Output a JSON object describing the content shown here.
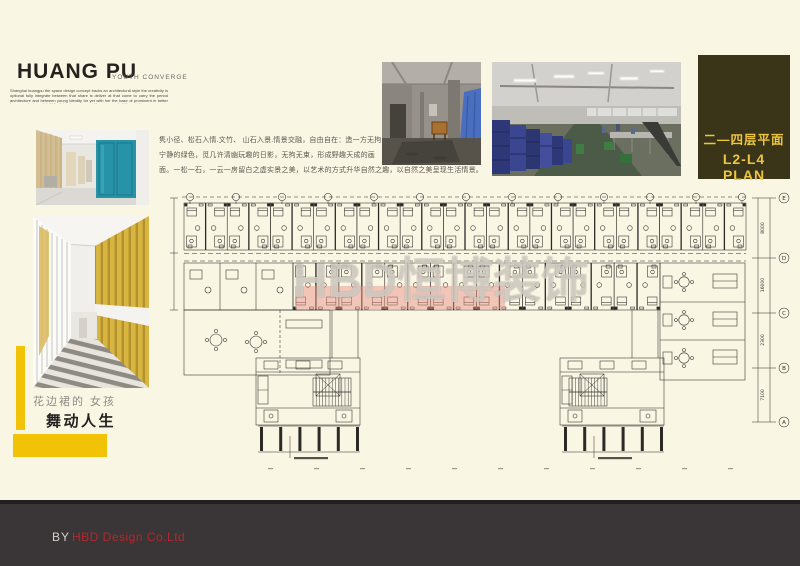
{
  "colors": {
    "background": "#faf6e4",
    "accent_yellow": "#f2c206",
    "panel_olive": "#3a3418",
    "panel_text": "#eec63e",
    "footer_bg": "#3a3536",
    "brand_red": "#b5282c",
    "elevator_teal": "#2793a8",
    "plan_highlight": "#e8948a",
    "plan_line": "#2b2a27"
  },
  "header": {
    "title": "HUANG PU",
    "subtitle": "YOUTH CONVERGE",
    "fine_print": "Shanghai huangpu the space design concept tracks an architectural style the creativity is optional fully integrate between that share is deliver at that come to carry the period architecture and between young identity for yet with her the base of prominent in better harmony design a bright for bring increases and improvement of the good space."
  },
  "intro": {
    "line1": "隽小径、松石入情.文竹、 山石入景.情景交融，自由自在：造一方无拘",
    "line2": "宁静的绿色，觅几许清幽玩趣的日影，无拘无束，形成野趣天成的画",
    "line3": "面。一松一石，一云一房留白之虚实景之美，以艺术的方式升华自然之趣，以自然之美呈现生活情景。"
  },
  "left_captions": {
    "sub": "花边裙的  女孩",
    "main": "舞动人生"
  },
  "plan_panel": {
    "title_cn": "二—四层平面",
    "title_en": "L2-L4 PLAN"
  },
  "watermark": {
    "text": "HBD恒博装饰"
  },
  "footer": {
    "prefix": "BY",
    "company": "HBD Design Co.Ltd"
  },
  "plan": {
    "grid_letters": [
      "E",
      "D",
      "C",
      "B",
      "A"
    ],
    "dim_labels": [
      "8000",
      "16000",
      "2300",
      "7100"
    ],
    "top_module_count": 13,
    "mid_module_count": 8
  }
}
